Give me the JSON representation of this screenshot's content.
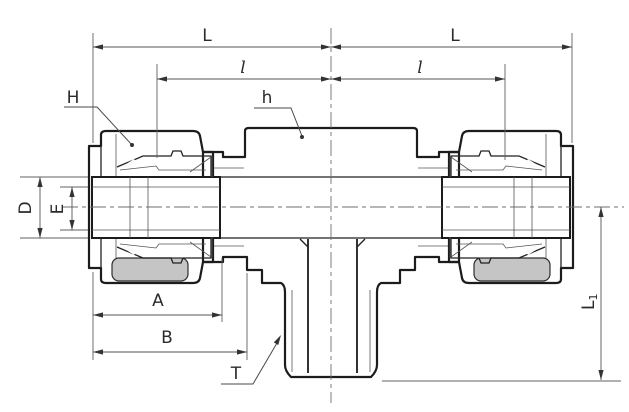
{
  "labels": {
    "L_left": "L",
    "L_right": "L",
    "l_left": "l",
    "l_right": "l",
    "H": "H",
    "h": "h",
    "D": "D",
    "E": "E",
    "A": "A",
    "B": "B",
    "T": "T",
    "L1_main": "L",
    "L1_sub": "1"
  },
  "colors": {
    "outline": "#1c1c1c",
    "body_fill": "#d9d9d9",
    "nut_fill": "#d2d2d2",
    "shadow_fill": "#c5c5c5",
    "dimension_line": "#555555",
    "label_text": "#2b2b2b",
    "background": "#ffffff"
  }
}
